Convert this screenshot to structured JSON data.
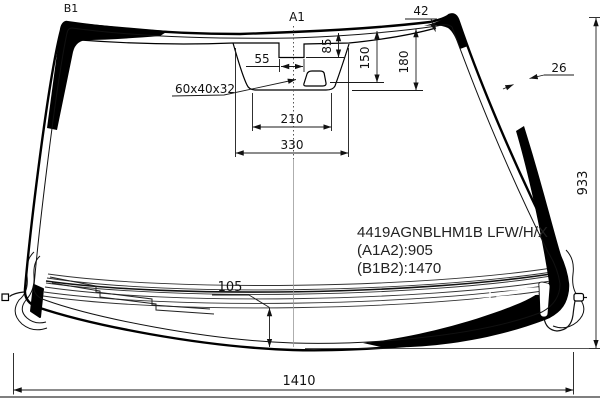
{
  "drawing": {
    "type": "windshield-glass-technical-drawing",
    "colors": {
      "ink": "#000000",
      "dim_line": "#1a1a1a",
      "background": "#ffffff",
      "centerline": "#9a9a9a"
    }
  },
  "diagram": {
    "markers": [
      {
        "id": "b1-marker",
        "text": "B1",
        "x": 71,
        "y": 12,
        "fs": 11,
        "anchor": "middle",
        "rot": 0
      },
      {
        "id": "a1-marker",
        "text": "A1",
        "x": 297,
        "y": 21,
        "fs": 12,
        "anchor": "middle",
        "rot": 0
      }
    ],
    "dimensions": [
      {
        "id": "dim-42",
        "text": "42",
        "x": 421,
        "y": 15,
        "fs": 12,
        "anchor": "middle",
        "rot": 0
      },
      {
        "id": "dim-85",
        "text": "85",
        "x": 331,
        "y": 46,
        "fs": 12,
        "anchor": "middle",
        "rot": -90
      },
      {
        "id": "dim-55",
        "text": "55",
        "x": 262,
        "y": 63,
        "fs": 12,
        "anchor": "middle",
        "rot": 0
      },
      {
        "id": "dim-150",
        "text": "150",
        "x": 369,
        "y": 58,
        "fs": 12,
        "anchor": "middle",
        "rot": -90
      },
      {
        "id": "dim-180",
        "text": "180",
        "x": 408,
        "y": 62,
        "fs": 12,
        "anchor": "middle",
        "rot": -90
      },
      {
        "id": "dim-26",
        "text": "26",
        "x": 559,
        "y": 72,
        "fs": 12,
        "anchor": "middle",
        "rot": 0
      },
      {
        "id": "dim-60x40x32",
        "text": "60x40x32",
        "x": 175,
        "y": 93,
        "fs": 12,
        "anchor": "start",
        "rot": 0
      },
      {
        "id": "dim-210",
        "text": "210",
        "x": 292,
        "y": 123,
        "fs": 12,
        "anchor": "middle",
        "rot": 0
      },
      {
        "id": "dim-330",
        "text": "330",
        "x": 292,
        "y": 149,
        "fs": 12,
        "anchor": "middle",
        "rot": 0
      },
      {
        "id": "dim-933",
        "text": "933",
        "x": 587,
        "y": 183,
        "fs": 13,
        "anchor": "middle",
        "rot": -90
      },
      {
        "id": "dim-105",
        "text": "105",
        "x": 230,
        "y": 291,
        "fs": 13,
        "anchor": "middle",
        "rot": 0
      },
      {
        "id": "dim-1410",
        "text": "1410",
        "x": 299,
        "y": 385,
        "fs": 13,
        "anchor": "middle",
        "rot": 0
      }
    ],
    "part_info": [
      {
        "id": "part-code",
        "text": "4419AGNBLHM1B LFW/H/X",
        "x": 357,
        "y": 237,
        "fs": 15,
        "anchor": "start",
        "rot": 0
      },
      {
        "id": "dim-a1a2",
        "text": "(A1A2):905",
        "x": 357,
        "y": 255,
        "fs": 15,
        "anchor": "start",
        "rot": 0
      },
      {
        "id": "dim-b1b2",
        "text": "(B1B2):1470",
        "x": 357,
        "y": 273,
        "fs": 15,
        "anchor": "start",
        "rot": 0
      }
    ]
  }
}
